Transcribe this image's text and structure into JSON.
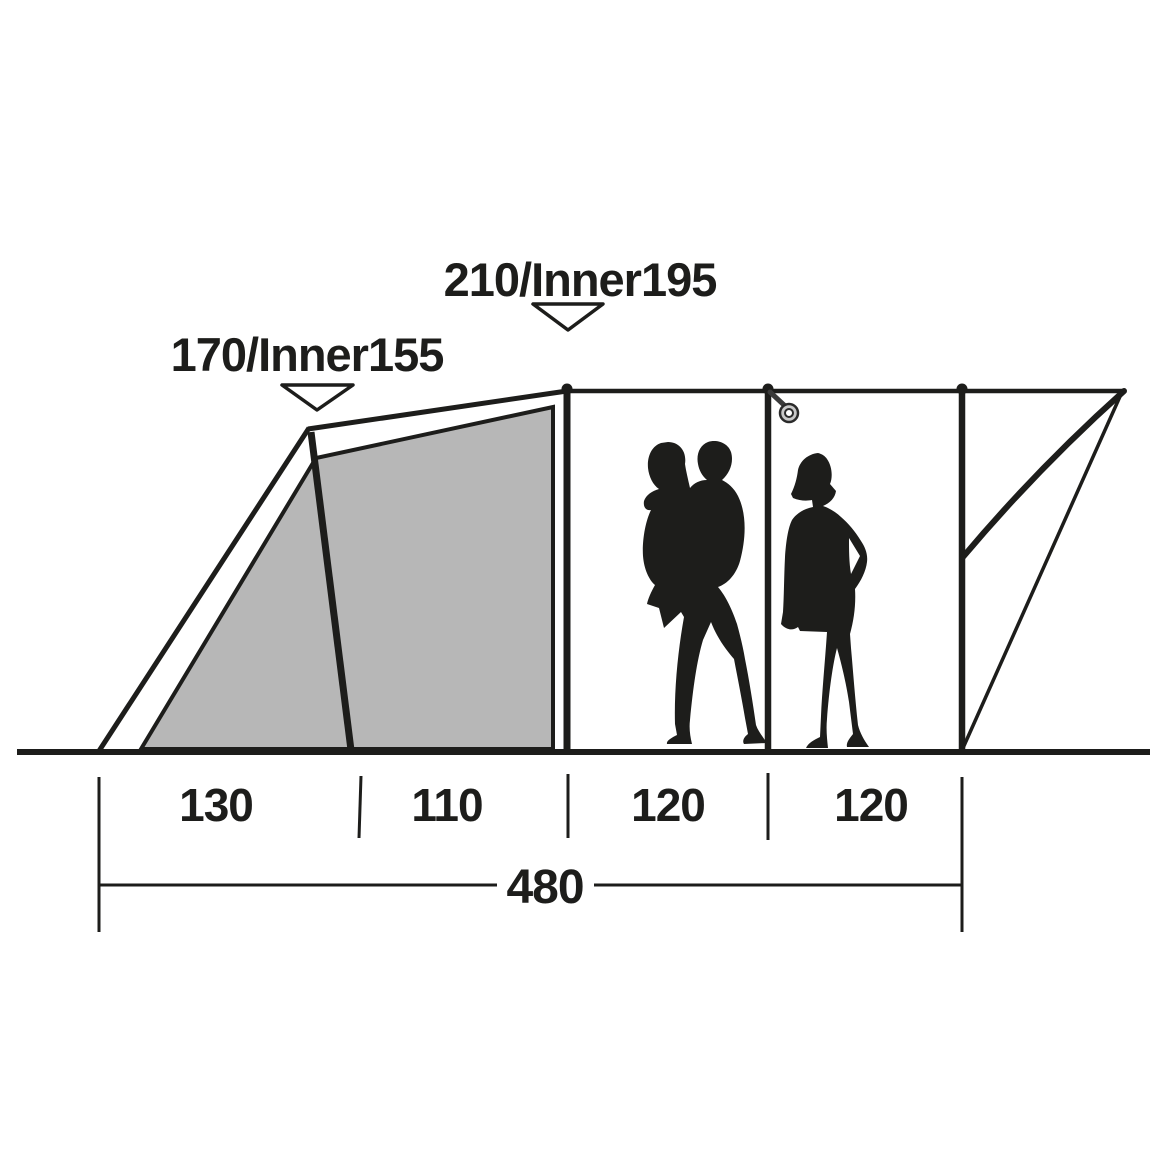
{
  "figure": {
    "peak_height_label": "210/Inner195",
    "front_height_label": "170/Inner155",
    "section_widths": [
      "130",
      "110",
      "120",
      "120"
    ],
    "total_width": "480"
  },
  "measurements": {
    "peak_height_cm": 210,
    "peak_inner_height_cm": 195,
    "front_height_cm": 170,
    "front_inner_height_cm": 155,
    "section_widths_cm": [
      130,
      110,
      120,
      120
    ],
    "total_width_cm": 480
  },
  "colors": {
    "line": "#1d1d1b",
    "inner_tent_gray": "#b7b7b7",
    "background": "#ffffff"
  },
  "icons": [
    {
      "name": "down-triangle-marker"
    },
    {
      "name": "lantern-ring-icon"
    }
  ],
  "silhouettes": [
    "adult carrying child",
    "woman standing"
  ]
}
